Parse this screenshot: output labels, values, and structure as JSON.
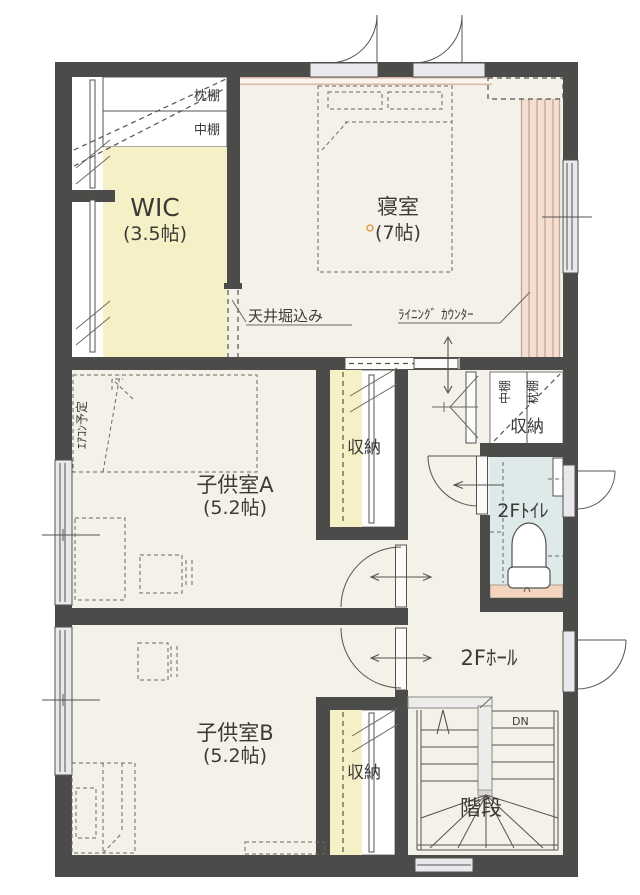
{
  "plan": {
    "rooms": {
      "wic": {
        "name": "WIC",
        "size": "(3.5帖)"
      },
      "bedroom": {
        "name": "寝室",
        "size": "(7帖)"
      },
      "child_a": {
        "name": "子供室A",
        "size": "(5.2帖)"
      },
      "child_b": {
        "name": "子供室B",
        "size": "(5.2帖)"
      },
      "toilet": {
        "name": "2Fﾄｲﾚ"
      },
      "hall": {
        "name": "2Fﾎｰﾙ"
      },
      "stairs": {
        "name": "階段"
      }
    },
    "closets": {
      "child_a": "収納",
      "child_b": "収納",
      "hall": "収納"
    },
    "shelf_labels": {
      "pillow_shelf": "枕棚",
      "middle_shelf": "中棚",
      "closet_middle": "中棚",
      "closet_pillow": "枕棚"
    },
    "annotations": {
      "ceiling_recess": "天井堀込み",
      "lining_counter": "ﾗｲﾆﾝｸﾞ ｶｳﾝﾀｰ",
      "aircon_planned": "ｴｱｺﾝ予定",
      "stairs_down": "DN"
    },
    "colors": {
      "wall": "#4b4b49",
      "floor": "#f4f1e9",
      "wic_floor": "#f6f0c6",
      "toilet_floor": "#ddeae9",
      "counter_fill": "#f2ded3",
      "counter_line": "#c9a28f",
      "toilet_shelf": "#f2d4bf",
      "window_glass": "#e9e9ed",
      "line": "#55534e"
    }
  }
}
